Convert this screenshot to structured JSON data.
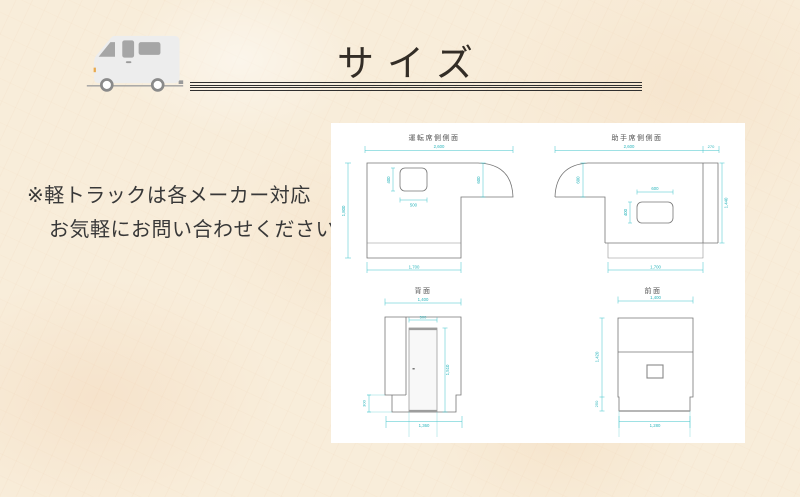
{
  "header": {
    "title": "サイズ",
    "truck_icon": "kei-camper-truck-icon"
  },
  "note": {
    "line1": "※軽トラックは各メーカー対応",
    "line2": "お気軽にお問い合わせください"
  },
  "diagram_panel": {
    "drawings": [
      {
        "id": "driver-side",
        "title": "運転席側側面",
        "dims": {
          "total_length": "2,600",
          "height": "1,800",
          "overcab_height": "600",
          "window_width": "500",
          "window_height": "400",
          "bottom_length": "1,700"
        }
      },
      {
        "id": "passenger-side",
        "title": "助手席側側面",
        "dims": {
          "total_length": "2,600",
          "top_overhang": "270",
          "overcab_height": "600",
          "window_width": "600",
          "window_height": "400",
          "right_height": "1,440",
          "bottom_length": "1,700"
        }
      },
      {
        "id": "rear-view",
        "title": "背面",
        "dims": {
          "width": "1,400",
          "door_width": "500",
          "door_height": "1,510",
          "step_height": "300",
          "bottom_width": "1,360"
        }
      },
      {
        "id": "front-view",
        "title": "前面",
        "dims": {
          "width": "1,400",
          "height": "1,420",
          "step_height": "250",
          "bottom_width": "1,280"
        }
      }
    ]
  },
  "colors": {
    "background": "#f8edda",
    "panel": "#ffffff",
    "dimension_line": "#3fc3c9",
    "drawing_outline": "#757575",
    "title_text": "#332d26",
    "note_text": "#383838",
    "rule_line": "#2f2f2f"
  }
}
